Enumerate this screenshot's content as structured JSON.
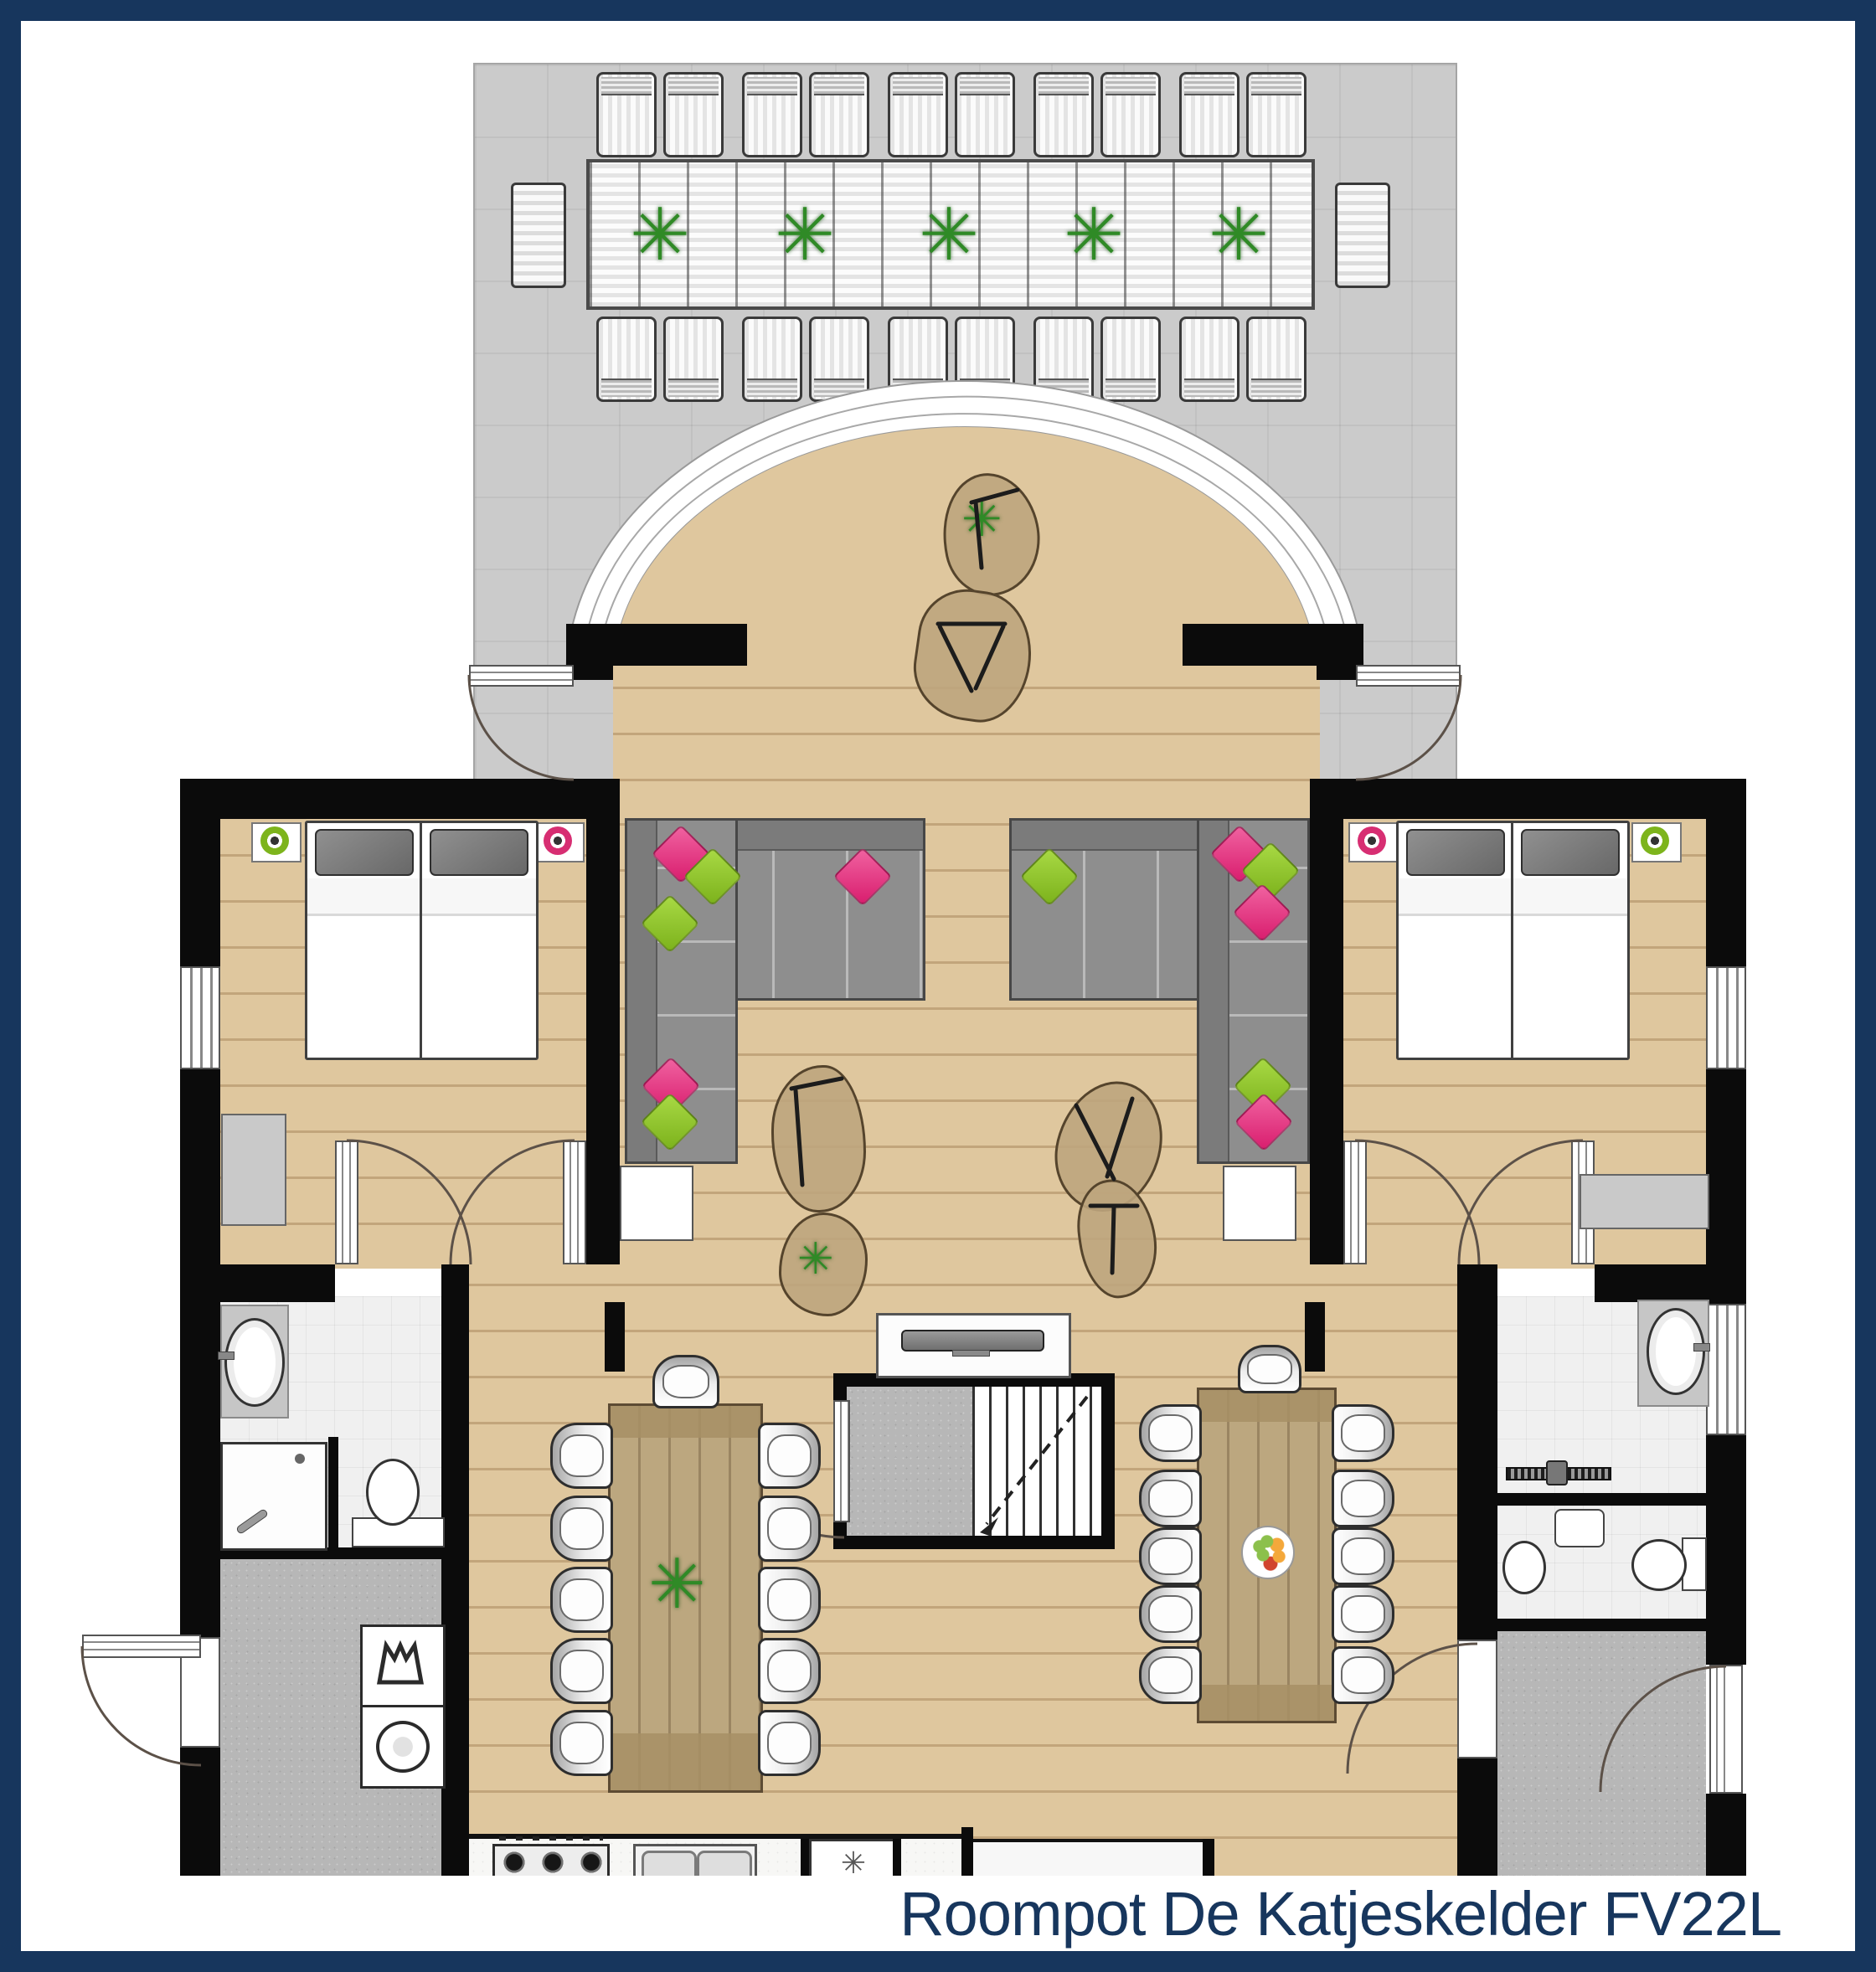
{
  "title": "Roompot De Katjeskelder FV22L",
  "glyphs": {
    "plant": "✳",
    "snowflake": "✳"
  },
  "palette": {
    "frame_navy": "#17365d",
    "title_text_navy": "#17365d",
    "wall_black": "#0b0b0b",
    "wood_floor": "#dfc79e",
    "terrace_gray": "#cbcbcb",
    "bathroom_tile": "#f0f0f0",
    "utility_concrete": "#b7b7b7",
    "sofa_gray": "#8e8e8e",
    "cushion_pink": "#d91d6e",
    "cushion_green": "#7cb21c",
    "lamp_green": "#7db41c",
    "lamp_pink": "#d72e72",
    "dining_table_wood": "#bca77f",
    "plant_green": "#2f8a26"
  },
  "plan": {
    "rooms": [
      "terrace",
      "veranda-arch",
      "living-room",
      "bedroom-left",
      "bedroom-right",
      "bathroom-left",
      "utility-room-left",
      "bathroom-right",
      "toilet-room-right",
      "entrance-hall-right",
      "kitchen",
      "staircase"
    ],
    "furniture_counts": {
      "outdoor_loungers": 20,
      "outdoor_end_benches": 2,
      "outdoor_table_plants": 5,
      "corner_sofas": 2,
      "sofa_cushions": 12,
      "coffee_tables": 6,
      "dining_tables": 2,
      "dining_chairs": 24,
      "single_beds": 4,
      "nightstand_lamps": 4,
      "wardrobes": 2,
      "toilets": 3,
      "sinks": 4,
      "showers": 2,
      "washing_machine": 1,
      "dryer": 1,
      "hob_burners": 4,
      "tv": 1
    }
  }
}
